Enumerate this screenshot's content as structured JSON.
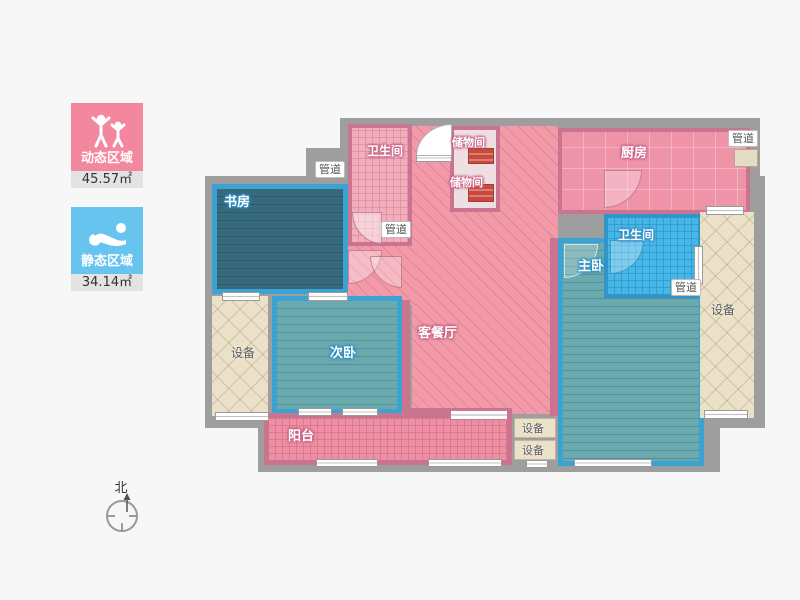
{
  "legend": {
    "dynamic": {
      "label": "动态区域",
      "area": "45.57㎡",
      "icon": "cheering-people-icon",
      "color": "#f2879e"
    },
    "static": {
      "label": "静态区域",
      "area": "34.14㎡",
      "icon": "sleeping-person-icon",
      "color": "#66c4ef"
    }
  },
  "compass": {
    "north_label": "北"
  },
  "rooms": {
    "study": {
      "label": "书房"
    },
    "bath_top": {
      "label": "卫生间"
    },
    "storage_upper": {
      "label": "储物间"
    },
    "storage_lower": {
      "label": "储物间"
    },
    "kitchen": {
      "label": "厨房"
    },
    "living_dining": {
      "label": "客餐厅"
    },
    "bath_right": {
      "label": "卫生间"
    },
    "master_bedroom": {
      "label": "主卧"
    },
    "second_bedroom": {
      "label": "次卧"
    },
    "balcony": {
      "label": "阳台"
    },
    "equipment_left": {
      "label": "设备"
    },
    "equipment_right": {
      "label": "设备"
    },
    "equipment_small_top": {
      "label": "设备"
    },
    "equipment_small_bottom": {
      "label": "设备"
    },
    "duct_entry_hall": {
      "label": "管道"
    },
    "duct_below_bath": {
      "label": "管道"
    },
    "duct_master": {
      "label": "管道"
    },
    "duct_kitchen": {
      "label": "管道"
    }
  },
  "colors": {
    "dynamic_accent": "#f2879e",
    "static_accent": "#66c4ef",
    "pink_room": "#f29aa8",
    "pink_wall": "#c9758f",
    "teal_floor": "#68a8ad",
    "dark_teal_floor": "#34687a",
    "blue_room_border": "#3ba3d4",
    "blue_tile": "#49b6e8",
    "equipment_floor": "#ebe1c9",
    "wall": "#9e9e9e",
    "background": "#f7f7f7"
  }
}
